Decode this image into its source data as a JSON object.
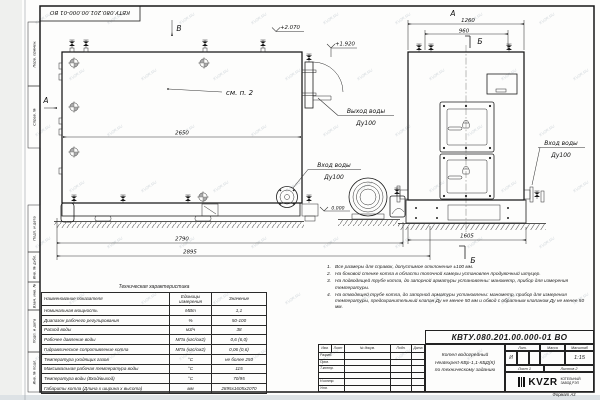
{
  "sheet": {
    "stamp_top": "КВТУ.080.201.00.000-01  ВО",
    "format_label": "Формат    А3",
    "watermark": "KVZR.RU",
    "side_labels": [
      "Перв. примен.",
      "Справ. №",
      "Подп. и дата",
      "Инв. № дубл.",
      "Взам. инв. №",
      "Подп. и дата",
      "Инв. № подл."
    ]
  },
  "drawing": {
    "view_b": "В",
    "view_a": "А",
    "front_view_label": "А",
    "section_b": "Б",
    "see_note": "см. п. 2",
    "elev_top": "+2.070",
    "elev_outlet": "+1.920",
    "elev_zero": "0.000",
    "outlet_line1": "Выход воды",
    "outlet_line2": "Ду100",
    "inlet_line1": "Вход воды",
    "inlet_line2": "Ду100",
    "dims": {
      "body_len": "2650",
      "base_len": "2790",
      "total_len": "2895",
      "front_w": "1260",
      "front_w2": "960",
      "depth": "1605"
    }
  },
  "tech_table": {
    "title": "Техническая характеристика",
    "headers": {
      "name": "Наименование показателя",
      "units": "Единицы измерения",
      "value": "Значение"
    },
    "rows": [
      {
        "name": "Номинальная мощность",
        "units": "МВт",
        "value": "1,1"
      },
      {
        "name": "Диапазон рабочего регулирования",
        "units": "%",
        "value": "50-100"
      },
      {
        "name": "Расход воды",
        "units": "м3/ч",
        "value": "38"
      },
      {
        "name": "Рабочее давление воды",
        "units": "МПа (кгс/см2)",
        "value": "0,6 (6,0)"
      },
      {
        "name": "Гидравлическое сопротивление котла",
        "units": "МПа (кгс/см2)",
        "value": "0,06 (0,6)"
      },
      {
        "name": "Температура уходящих газов",
        "units": "°С",
        "value": "не более 250"
      },
      {
        "name": "Максимальная рабочая температура воды",
        "units": "°С",
        "value": "115"
      },
      {
        "name": "Температура воды (Вход/выход)",
        "units": "°С",
        "value": "70/95"
      },
      {
        "name": "Габариты котла (Длина х ширина х высота)",
        "units": "мм",
        "value": "2895х1605х2070"
      }
    ]
  },
  "notes": {
    "items": [
      {
        "num": "1.",
        "text": "Все размеры для справок, допустимое отклонение ±100 мм."
      },
      {
        "num": "2.",
        "text": "На боковой стенке котла в области топочной камеры установлен продувочный штуцер."
      },
      {
        "num": "3.",
        "text": "На подводящей трубе котла, до запорной арматуры установлены: манометр, прибор для измерения температуры."
      },
      {
        "num": "4.",
        "text": "На отводящей трубе котла, до запорной арматуры установлены: манометр, прибор для измерения температуры, предохранительный клапан Ду не менее 50 мм и обвод с обратным клапаном Ду не менее 50 мм."
      }
    ]
  },
  "title_block": {
    "doc_number": "КВТУ.080.201.00.000-01  ВО",
    "product_line1": "Котел водогрейный",
    "product_line2": "Heatexpert-КВр-1,1-КБД(К)",
    "product_line3": "по техническому заданию",
    "header_cols": [
      "Изм.",
      "Лист",
      "№ докум.",
      "Подп.",
      "Дата"
    ],
    "row_labels": [
      "Разраб.",
      "Пров.",
      "Т.контр.",
      "",
      "Н.контр.",
      "Утв."
    ],
    "lit_header": "Лит.",
    "mass_header": "Масса",
    "scale_header": "Масштаб",
    "lit_value": "И",
    "scale_value": "1:15",
    "sheet_label": "Лист  1",
    "sheets_label": "Листов  2",
    "logo_text": "KVZR",
    "logo_sub1": "КОТЕЛЬНЫЙ",
    "logo_sub2": "ЗАВОД РЭП"
  }
}
